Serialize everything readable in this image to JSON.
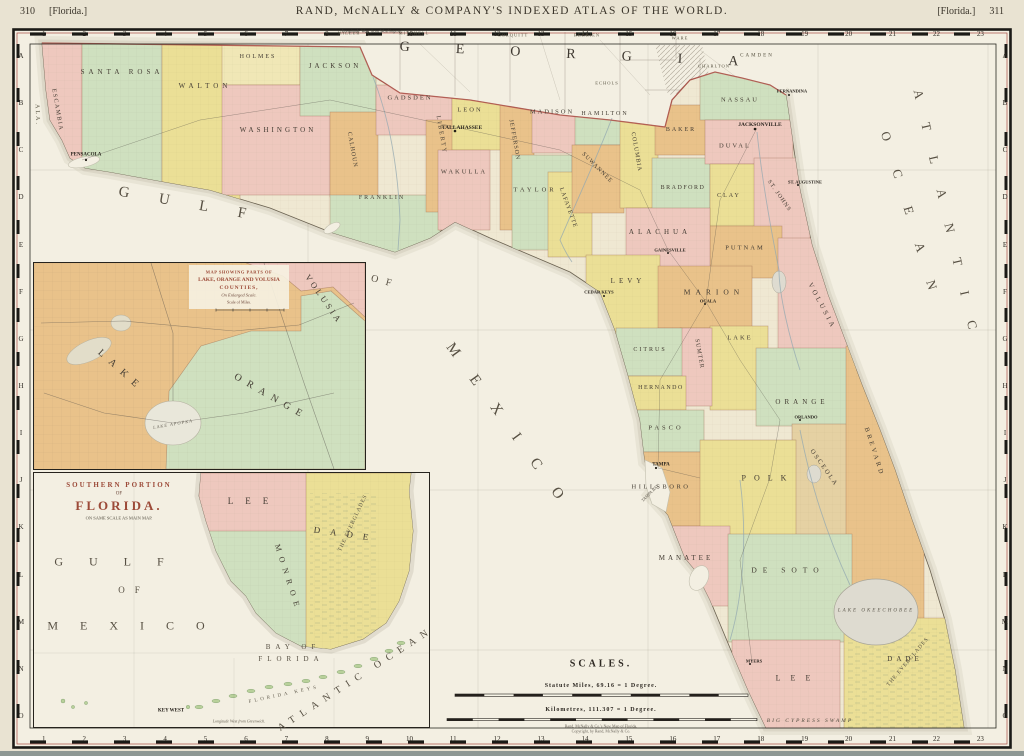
{
  "header": {
    "page_left": "310",
    "bracket_left": "[Florida.]",
    "title": "RAND, McNALLY & COMPANY'S INDEXED ATLAS OF THE WORLD.",
    "bracket_right": "[Florida.]",
    "page_right": "311"
  },
  "border": {
    "cols": [
      "1",
      "2",
      "3",
      "4",
      "5",
      "6",
      "7",
      "8",
      "9",
      "10",
      "11",
      "12",
      "13",
      "14",
      "15",
      "16",
      "17",
      "18",
      "19",
      "20",
      "21",
      "22",
      "23"
    ],
    "rows": [
      "A",
      "B",
      "C",
      "D",
      "E",
      "F",
      "G",
      "H",
      "I",
      "J",
      "K",
      "L",
      "M",
      "N",
      "O"
    ],
    "longitude_note": "Longitude West from Washington."
  },
  "georgia": {
    "state_label": "GEORGIA",
    "alabama_label": "ALA.",
    "counties": [
      "MILLER",
      "MITCHELL",
      "COLQUITT",
      "BERRIEN",
      "ECHOLS",
      "WARE",
      "CHARLTON",
      "CAMDEN"
    ]
  },
  "main_map": {
    "counties": [
      {
        "name": "ESCAMBIA",
        "color": "#eec8be"
      },
      {
        "name": "SANTA ROSA",
        "color": "#cfe0bf"
      },
      {
        "name": "WALTON",
        "color": "#ebdf96"
      },
      {
        "name": "HOLMES",
        "color": "#f0e7b6"
      },
      {
        "name": "WASHINGTON",
        "color": "#eec8be"
      },
      {
        "name": "JACKSON",
        "color": "#cfe0bf"
      },
      {
        "name": "CALHOUN",
        "color": "#e9c28a"
      },
      {
        "name": "FRANKLIN",
        "color": "#cfe0bf"
      },
      {
        "name": "GADSDEN",
        "color": "#eec8be"
      },
      {
        "name": "LIBERTY",
        "color": "#e9c28a"
      },
      {
        "name": "LEON",
        "color": "#ebdf96"
      },
      {
        "name": "WAKULLA",
        "color": "#eec8be"
      },
      {
        "name": "JEFFERSON",
        "color": "#e9c28a"
      },
      {
        "name": "MADISON",
        "color": "#eec8be"
      },
      {
        "name": "TAYLOR",
        "color": "#cfe0bf"
      },
      {
        "name": "LAFAYETTE",
        "color": "#ebdf96"
      },
      {
        "name": "HAMILTON",
        "color": "#cfe0bf"
      },
      {
        "name": "SUWANNEE",
        "color": "#e9c28a"
      },
      {
        "name": "COLUMBIA",
        "color": "#ebdf96"
      },
      {
        "name": "BAKER",
        "color": "#e9c28a"
      },
      {
        "name": "BRADFORD",
        "color": "#cfe0bf"
      },
      {
        "name": "NASSAU",
        "color": "#cfe0bf"
      },
      {
        "name": "DUVAL",
        "color": "#eec8be"
      },
      {
        "name": "CLAY",
        "color": "#ebdf96"
      },
      {
        "name": "ST. JOHNS",
        "color": "#eec8be"
      },
      {
        "name": "PUTNAM",
        "color": "#e9c28a"
      },
      {
        "name": "ALACHUA",
        "color": "#eec8be"
      },
      {
        "name": "LEVY",
        "color": "#ebdf96"
      },
      {
        "name": "MARION",
        "color": "#e9c28a"
      },
      {
        "name": "VOLUSIA",
        "color": "#eec8be"
      },
      {
        "name": "LAKE",
        "color": "#ebdf96"
      },
      {
        "name": "SUMTER",
        "color": "#eec8be"
      },
      {
        "name": "CITRUS",
        "color": "#cfe0bf"
      },
      {
        "name": "HERNANDO",
        "color": "#ebdf96"
      },
      {
        "name": "PASCO",
        "color": "#cfe0bf"
      },
      {
        "name": "ORANGE",
        "color": "#cfe0bf"
      },
      {
        "name": "OSCEOLA",
        "color": "#e5d1a3"
      },
      {
        "name": "BREVARD",
        "color": "#e9c28a"
      },
      {
        "name": "HILLSBORO",
        "color": "#e9c28a"
      },
      {
        "name": "POLK",
        "color": "#ebdf96"
      },
      {
        "name": "MANATEE",
        "color": "#eec8be"
      },
      {
        "name": "DE SOTO",
        "color": "#cfe0bf"
      },
      {
        "name": "LEE",
        "color": "#eec8be"
      },
      {
        "name": "DADE",
        "color": "#ebdf96"
      }
    ],
    "cities": [
      {
        "name": "PENSACOLA"
      },
      {
        "name": "TALLAHASSEE"
      },
      {
        "name": "JACKSONVILLE"
      },
      {
        "name": "FERNANDINA"
      },
      {
        "name": "ST. AUGUSTINE"
      },
      {
        "name": "GAINESVILLE"
      },
      {
        "name": "OCALA"
      },
      {
        "name": "ORLANDO"
      },
      {
        "name": "TAMPA"
      },
      {
        "name": "CEDAR KEYS"
      },
      {
        "name": "MYERS"
      }
    ],
    "water": {
      "gulf": "GULF",
      "of": "OF",
      "mexico": "MEXICO",
      "atlantic": "ATLANTIC",
      "ocean": "OCEAN"
    },
    "features": {
      "lake_okeechobee": "LAKE OKEECHOBEE",
      "everglades": "THE EVERGLADES",
      "big_cypress": "BIG CYPRESS SWAMP",
      "tampa_bay": "TAMPA BAY"
    }
  },
  "inset_lake_orange": {
    "title_lines": [
      "MAP SHOWING PARTS OF",
      "LAKE, ORANGE AND VOLUSIA",
      "COUNTIES,",
      "On Enlarged Scale.",
      "Scale of Miles."
    ],
    "counties": [
      "LAKE",
      "ORANGE",
      "VOLUSIA"
    ],
    "lake_apopka": "LAKE APOPKA"
  },
  "inset_southern": {
    "title_lines": [
      "SOUTHERN PORTION",
      "OF",
      "FLORIDA.",
      "ON SAME SCALE AS MAIN MAP."
    ],
    "counties": [
      "LEE",
      "MONROE",
      "DADE"
    ],
    "labels": {
      "gulf": "GULF",
      "of": "OF",
      "mexico": "MEXICO",
      "bay_of": "BAY OF",
      "florida": "FLORIDA",
      "atlantic_ocean": "ATLANTIC OCEAN",
      "everglades": "THE EVERGLADES",
      "key_west": "KEY WEST",
      "florida_keys": "FLORIDA KEYS"
    },
    "longitude_note": "Longitude West from Greenwich."
  },
  "scales": {
    "heading": "SCALES.",
    "miles_label": "Statute Miles, 69.16 = 1 Degree.",
    "km_label": "Kilometres, 111.307 = 1 Degree.",
    "imprint_lines": [
      "Rand, McNally & Co.'s New Map of Florida.",
      "Copyright, by Rand, McNally & Co."
    ]
  }
}
